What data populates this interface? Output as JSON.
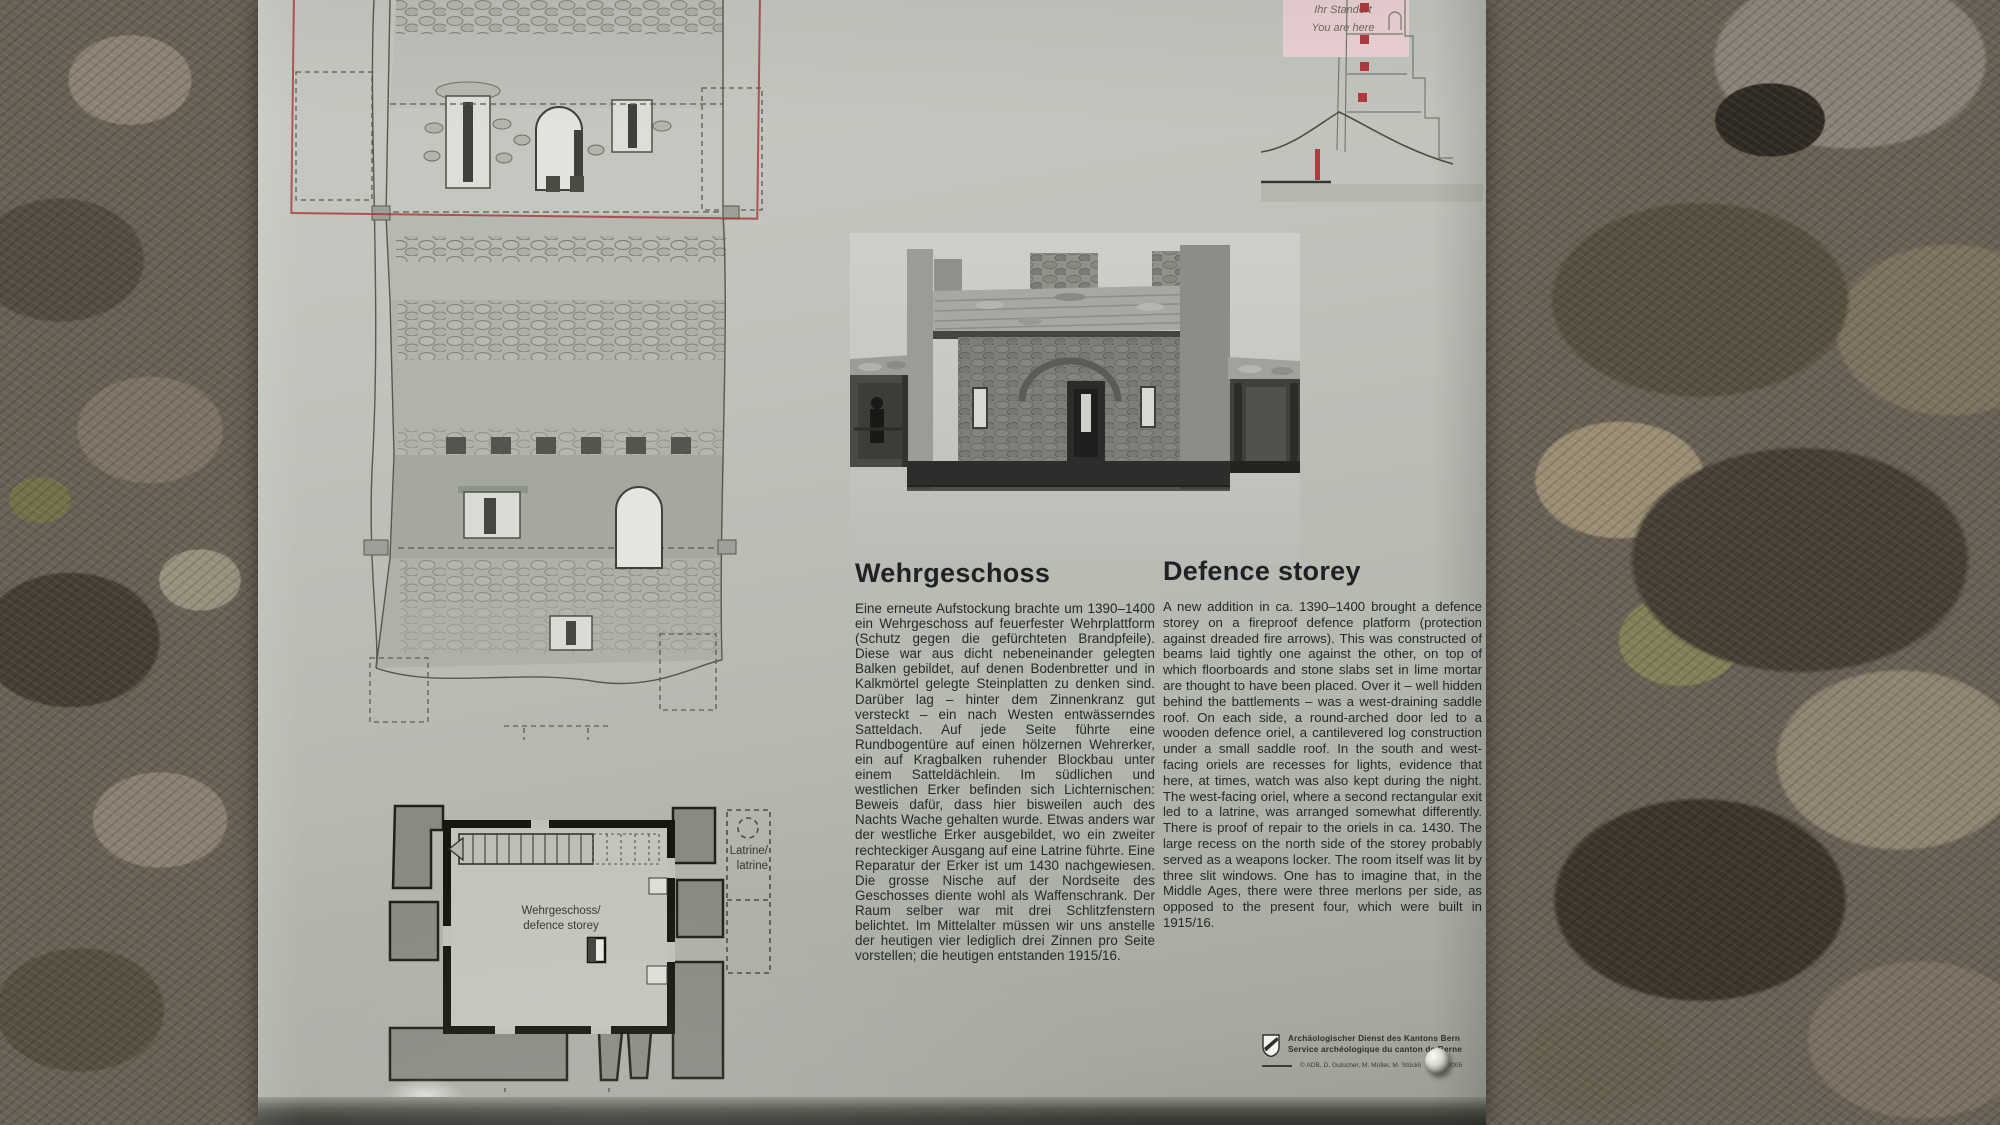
{
  "locator": {
    "line1": "Ihr Standort",
    "line2": "You are here"
  },
  "german": {
    "title": "Wehrgeschoss",
    "body": "Eine erneute Aufstockung brachte um 1390–1400 ein Wehrgeschoss auf feuerfester Wehrplattform (Schutz gegen die gefürchteten Brandpfeile). Diese war aus dicht nebeneinander gelegten Balken gebildet, auf denen Bodenbretter und in Kalkmörtel gelegte Steinplatten zu denken sind. Darüber lag – hinter dem Zinnenkranz gut versteckt – ein nach Westen entwässerndes Satteldach. Auf jede Seite führte eine Rundbogentüre auf einen hölzernen Wehrerker, ein auf Kragbalken ruhender Blockbau unter einem Satteldächlein. Im südlichen und westlichen Erker befinden sich Lichternischen: Beweis dafür, dass hier bisweilen auch des Nachts Wache gehalten wurde. Etwas anders war der westliche Erker ausgebildet, wo ein zweiter rechteckiger Ausgang auf eine Latrine führte. Eine Reparatur der Erker ist um 1430 nachgewiesen. Die grosse Nische auf der Nordseite des Geschosses diente wohl als Waffenschrank. Der Raum selber war mit drei Schlitzfenstern belichtet. Im Mittelalter müssen wir uns anstelle der heutigen vier lediglich drei Zinnen pro Seite vorstellen; die heutigen entstanden 1915/16."
  },
  "english": {
    "title": "Defence storey",
    "body": "A new addition in ca. 1390–1400 brought a defence storey on a fireproof defence platform (protection against dreaded fire arrows). This was constructed of beams laid tightly one against the other, on top of which floorboards and stone slabs set in lime mortar are thought to have been placed. Over it – well hidden behind the battlements – was a west-draining saddle roof. On each side, a round-arched door led to a wooden defence oriel, a cantilevered log construction under a small saddle roof. In the south and west-facing oriels are recesses for lights, evidence that here, at times, watch was also kept during the night. The west-facing oriel, where a second rectangular exit led to a latrine, was arranged somewhat differently. There is proof of repair to the oriels in ca. 1430. The large recess on the north side of the storey probably served as a weapons locker. The room itself was lit by three slit windows. One has to imagine that, in the Middle Ages, there were three merlons per side, as opposed to the present four, which were built in 1915/16."
  },
  "floor_plan": {
    "latrine_label_line1": "Latrine/",
    "latrine_label_line2": "latrine",
    "room_label_line1": "Wehrgeschoss/",
    "room_label_line2": "defence storey"
  },
  "credits": {
    "org_line1": "Archäologischer Dienst des Kantons Bern",
    "org_line2": "Service archéologique du canton de Berne",
    "copyright_line": "© ADB, D. Gutscher, M. Müller, M. Stöckli",
    "date": "Mai 2005"
  },
  "colors": {
    "accent_red": "#b03a40",
    "locator_pink": "#ecd3d5",
    "panel_gray": "#bcc0b7"
  }
}
